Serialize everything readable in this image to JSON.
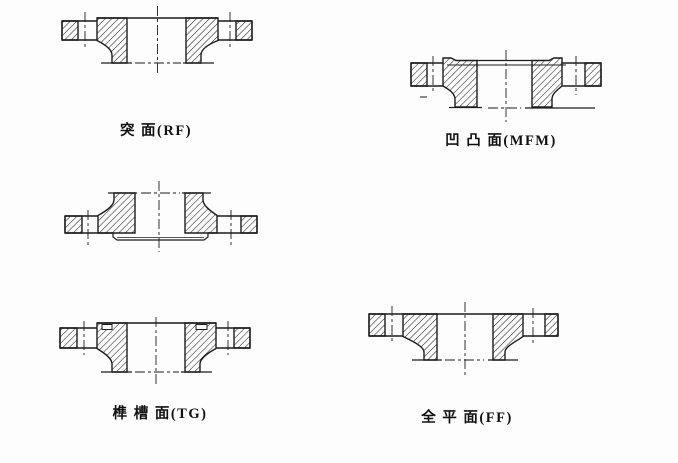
{
  "page": {
    "background": "#fdfdfd",
    "line_color": "#1c1c1c",
    "text_color": "#111111"
  },
  "figures": {
    "rf": {
      "caption": "突 面(RF)"
    },
    "mfm": {
      "caption": "凹 凸 面(MFM)"
    },
    "tg": {
      "caption": "榫 槽 面(TG)"
    },
    "ff": {
      "caption": "全 平 面(FF)"
    }
  }
}
